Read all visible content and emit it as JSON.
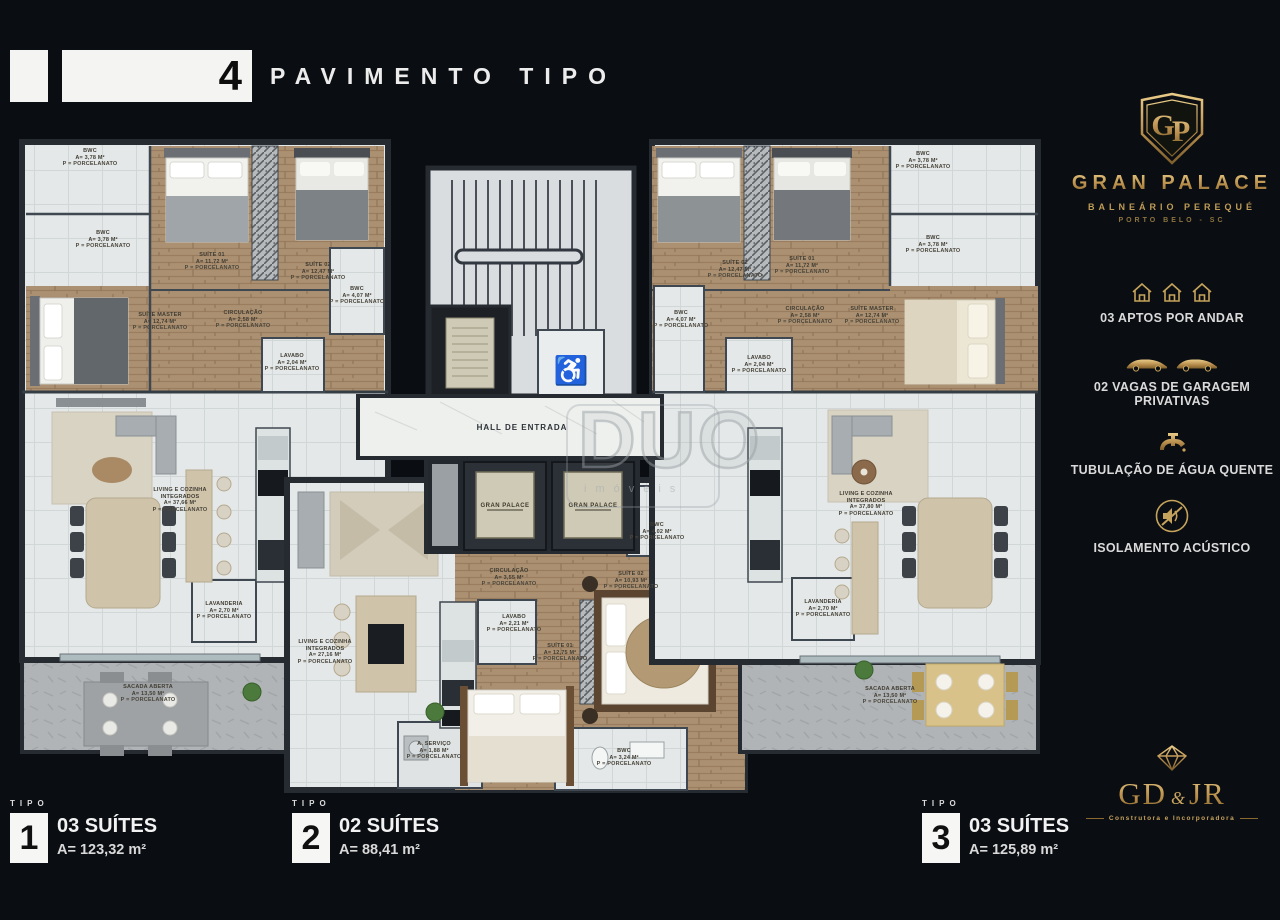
{
  "header": {
    "floor_number": "4",
    "title": "PAVIMENTO TIPO"
  },
  "brand": {
    "monogram": "GP",
    "name": "GRAN PALACE",
    "district": "BALNEÁRIO PEREQUÉ",
    "city": "PORTO BELO - SC"
  },
  "amenities": [
    {
      "icon": "houses-icon",
      "label": "03 APTOS POR ANDAR"
    },
    {
      "icon": "cars-icon",
      "label": "02 VAGAS DE GARAGEM PRIVATIVAS"
    },
    {
      "icon": "faucet-icon",
      "label": "TUBULAÇÃO DE ÁGUA QUENTE"
    },
    {
      "icon": "speaker-muted-icon",
      "label": "ISOLAMENTO ACÚSTICO"
    }
  ],
  "builder": {
    "name_left": "GD",
    "amp": "&",
    "name_right": "JR",
    "tagline": "Construtora e Incorporadora"
  },
  "legend": [
    {
      "tipo": "TIPO",
      "number": "1",
      "suites": "03 SUÍTES",
      "area": "A= 123,32 m²"
    },
    {
      "tipo": "TIPO",
      "number": "2",
      "suites": "02 SUÍTES",
      "area": "A= 88,41 m²"
    },
    {
      "tipo": "TIPO",
      "number": "3",
      "suites": "03 SUÍTES",
      "area": "A= 125,89 m²"
    }
  ],
  "plan": {
    "hall_label": "HALL DE ENTRADA",
    "elevator_label": "GRAN PALACE",
    "icons": {
      "accessible": "♿"
    },
    "watermark": {
      "name": "DUO",
      "word": "imóveis"
    },
    "tipo1": {
      "rooms": [
        {
          "name": "BWC",
          "area": "A= 3,78 m²",
          "floor": "P = Porcelanato"
        },
        {
          "name": "BWC",
          "area": "A= 3,78 m²",
          "floor": "P = Porcelanato"
        },
        {
          "name": "SUÍTE 01",
          "area": "A= 11,72 m²",
          "floor": "P = Porcelanato"
        },
        {
          "name": "SUÍTE 02",
          "area": "A= 12,47 m²",
          "floor": "P = Porcelanato"
        },
        {
          "name": "SUÍTE MASTER",
          "area": "A= 12,74 m²",
          "floor": "P = Porcelanato"
        },
        {
          "name": "CIRCULAÇÃO",
          "area": "A= 2,58 m²",
          "floor": "P = Porcelanato"
        },
        {
          "name": "LAVABO",
          "area": "A= 2,04 m²",
          "floor": "P = Porcelanato"
        },
        {
          "name": "BWC",
          "area": "A= 4,07 m²",
          "floor": "P = Porcelanato"
        },
        {
          "name": "LIVING E COZINHA INTEGRADOS",
          "area": "A= 37,66 m²",
          "floor": "P = Porcelanato"
        },
        {
          "name": "LAVANDERIA",
          "area": "A= 2,70 m²",
          "floor": "P = Porcelanato"
        },
        {
          "name": "SACADA ABERTA",
          "area": "A= 13,50 m²",
          "floor": "P = Porcelanato"
        }
      ]
    },
    "tipo2": {
      "rooms": [
        {
          "name": "LIVING E COZINHA INTEGRADOS",
          "area": "A= 27,16 m²",
          "floor": "P = Porcelanato"
        },
        {
          "name": "CIRCULAÇÃO",
          "area": "A= 3,55 m²",
          "floor": "P = Porcelanato"
        },
        {
          "name": "LAVABO",
          "area": "A= 2,21 m²",
          "floor": "P = Porcelanato"
        },
        {
          "name": "SUÍTE 01",
          "area": "A= 12,75 m²",
          "floor": "P = Porcelanato"
        },
        {
          "name": "SUÍTE 02",
          "area": "A= 10,93 m²",
          "floor": "P = Porcelanato"
        },
        {
          "name": "BWC",
          "area": "A= 4,02 m²",
          "floor": "P = Porcelanato"
        },
        {
          "name": "A. SERVIÇO",
          "area": "A= 1,88 m²",
          "floor": "P = Porcelanato"
        },
        {
          "name": "BWC",
          "area": "A= 3,24 m²",
          "floor": "P = Porcelanato"
        }
      ]
    },
    "tipo3": {
      "rooms": [
        {
          "name": "SUÍTE 02",
          "area": "A= 12,47 m²",
          "floor": "P = Porcelanato"
        },
        {
          "name": "SUÍTE 01",
          "area": "A= 11,72 m²",
          "floor": "P = Porcelanato"
        },
        {
          "name": "BWC",
          "area": "A= 3,78 m²",
          "floor": "P = Porcelanato"
        },
        {
          "name": "BWC",
          "area": "A= 3,78 m²",
          "floor": "P = Porcelanato"
        },
        {
          "name": "BWC",
          "area": "A= 4,07 m²",
          "floor": "P = Porcelanato"
        },
        {
          "name": "CIRCULAÇÃO",
          "area": "A= 2,58 m²",
          "floor": "P = Porcelanato"
        },
        {
          "name": "SUÍTE MASTER",
          "area": "A= 12,74 m²",
          "floor": "P = Porcelanato"
        },
        {
          "name": "LAVABO",
          "area": "A= 2,04 m²",
          "floor": "P = Porcelanato"
        },
        {
          "name": "LIVING E COZINHA INTEGRADOS",
          "area": "A= 37,80 m²",
          "floor": "P = Porcelanato"
        },
        {
          "name": "LAVANDERIA",
          "area": "A= 2,70 m²",
          "floor": "P = Porcelanato"
        },
        {
          "name": "SACADA ABERTA",
          "area": "A= 13,50 m²",
          "floor": "P = Porcelanato"
        }
      ]
    }
  }
}
